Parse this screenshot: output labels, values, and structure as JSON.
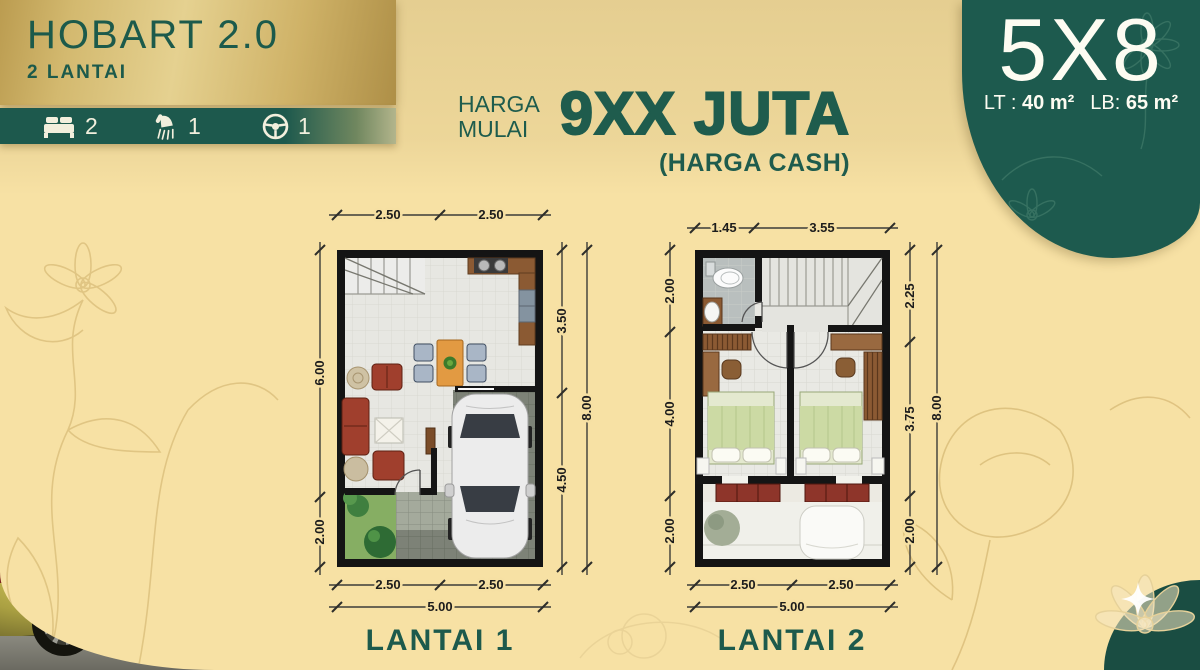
{
  "header": {
    "title": "HOBART 2.0",
    "subtitle": "2 LANTAI"
  },
  "features": [
    {
      "icon": "bed-icon",
      "count": "2"
    },
    {
      "icon": "shower-icon",
      "count": "1"
    },
    {
      "icon": "steering-wheel-icon",
      "count": "1"
    }
  ],
  "price": {
    "label_line1": "HARGA",
    "label_line2": "MULAI",
    "amount": "9XX JUTA",
    "note": "(HARGA CASH)"
  },
  "size_badge": {
    "dimensions": "5X8",
    "lt_label": "LT :",
    "lt_value": "40 m²",
    "lb_label": "LB:",
    "lb_value": "65 m²"
  },
  "floorplans": [
    {
      "label": "LANTAI 1",
      "dims": {
        "top": [
          "2.50",
          "2.50"
        ],
        "left": [
          "6.00",
          "2.00"
        ],
        "right_inner": [
          "3.50",
          "4.50"
        ],
        "right_outer": "8.00",
        "bottom": [
          "2.50",
          "2.50"
        ],
        "bottom_total": "5.00"
      }
    },
    {
      "label": "LANTAI 2",
      "dims": {
        "top": [
          "1.45",
          "3.55"
        ],
        "left": [
          "2.00",
          "4.00",
          "2.00"
        ],
        "right_inner": [
          "2.25",
          "3.75",
          "2.00"
        ],
        "right_outer": "8.00",
        "bottom": [
          "2.50",
          "2.50"
        ],
        "bottom_total": "5.00"
      }
    }
  ],
  "colors": {
    "accent_green": "#1d5a4c",
    "panel_green": "#1d5a4e",
    "gold": "#cdb168",
    "cream": "#f7e1a4"
  }
}
